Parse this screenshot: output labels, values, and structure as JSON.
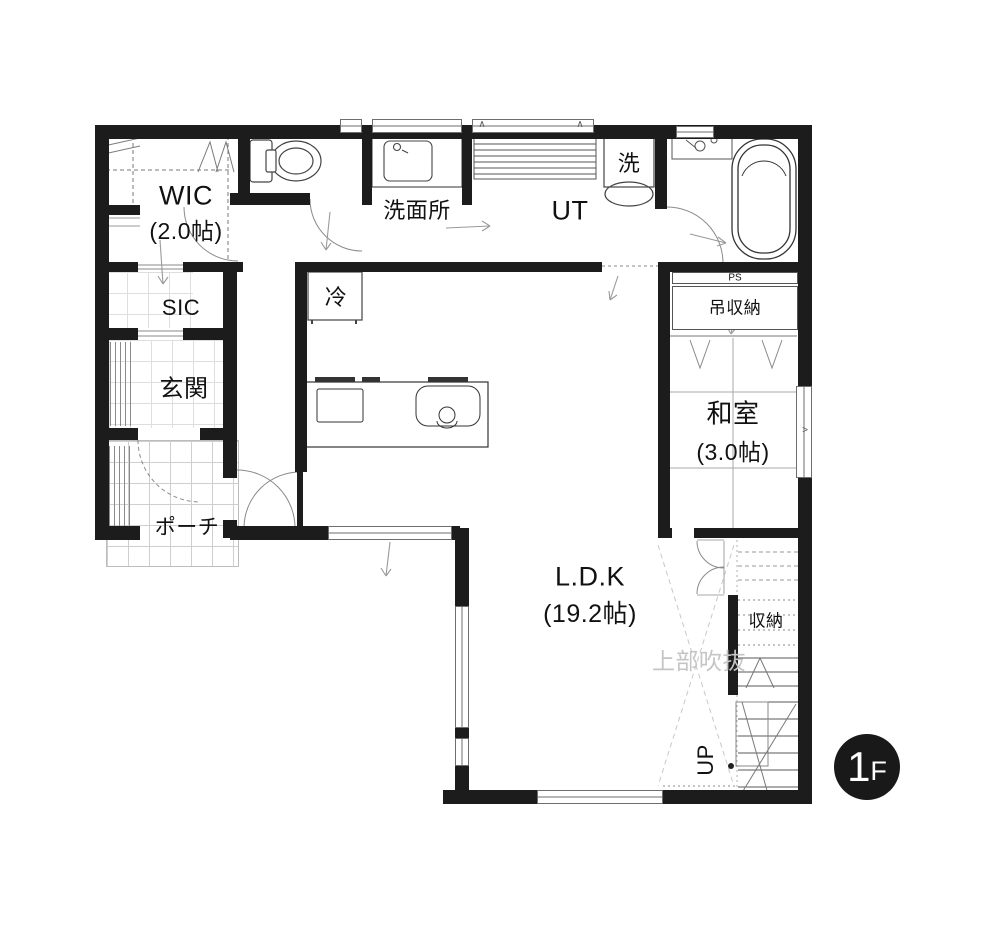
{
  "floor_badge": {
    "number": "1",
    "letter": "F"
  },
  "rooms": {
    "wic": {
      "label": "WIC",
      "size": "(2.0帖)"
    },
    "sic": {
      "label": "SIC"
    },
    "genkan": {
      "label": "玄関"
    },
    "porch": {
      "label": "ポーチ"
    },
    "washroom": {
      "label": "洗面所"
    },
    "utility": {
      "label": "UT"
    },
    "washer": {
      "label": "洗"
    },
    "fridge": {
      "label": "冷"
    },
    "pipe_space": {
      "label": "PS"
    },
    "hanging_storage": {
      "label": "吊収納"
    },
    "japanese_room": {
      "label": "和室",
      "size": "(3.0帖)"
    },
    "ldk": {
      "label": "L.D.K",
      "size": "(19.2帖)"
    },
    "storage": {
      "label": "収納"
    },
    "stairs": {
      "label": "UP"
    },
    "void_above": {
      "label": "上部吹抜"
    }
  },
  "markers": {
    "high_window": "∧",
    "window_chevron": ">"
  },
  "colors": {
    "wall": "#1c1c1c",
    "thin_line": "#666666",
    "light_line": "#aaaaaa",
    "grid_line": "#cfcfcf",
    "void_text": "#c5c5c5",
    "badge_bg": "#191919",
    "badge_text": "#ffffff"
  }
}
